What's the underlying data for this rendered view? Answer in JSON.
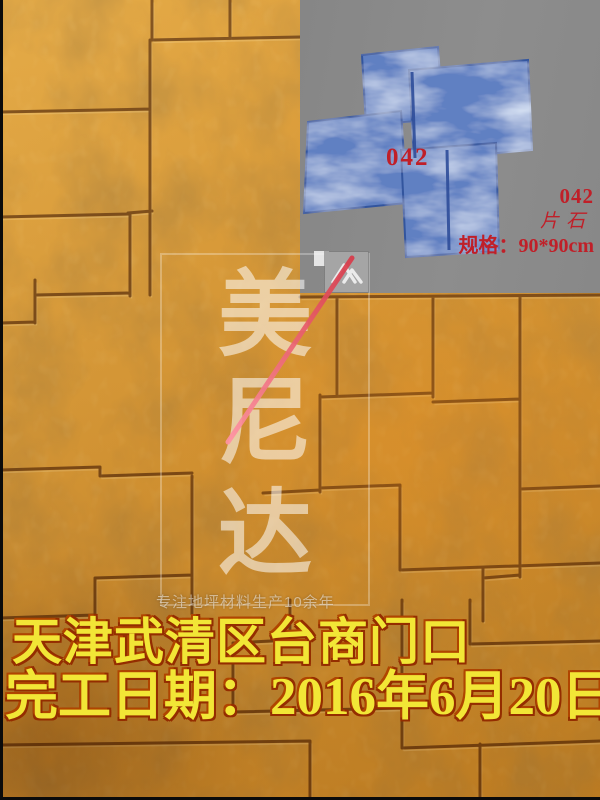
{
  "photo": {
    "description": "stamped concrete floor, amber ashlar slate pattern",
    "floor_base_color": "#d8953a",
    "grout_color": "#5c2e08"
  },
  "inset": {
    "panel_color": "#8a8a8a",
    "mold_color": "#6080c2",
    "label_color": "#c01f28",
    "mold_code_label": "042",
    "side_labels": {
      "code": "042",
      "material": "片石",
      "spec": "规格：90*90cm"
    }
  },
  "watermark": {
    "brand_chars": [
      "美",
      "尼",
      "达"
    ],
    "tagline": "专注地坪材料生产10余年",
    "logo": "mountain-logo",
    "slash_color": "#e03a4a"
  },
  "caption": {
    "line1": "天津武清区台商门口",
    "line2": "完工日期：2016年6月20日",
    "text_color": "#f2e636"
  }
}
